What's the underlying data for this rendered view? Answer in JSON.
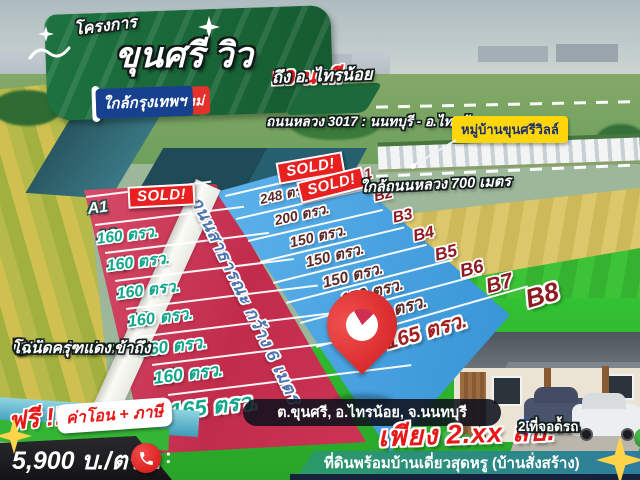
{
  "poster": {
    "project_label": "โครงการ",
    "project_name": "ขุนศรี วิว",
    "tagline_left": "พื้นที่ความสุขใหม่",
    "tagline_right": "ใกล้กรุงเทพฯ"
  },
  "callouts": {
    "travel_time": "10 นาที",
    "travel_dest": "ถึง อ. ไทรน้อย",
    "highway": "ถนนหลวง 3017 : นนทบุรี - อ.ไทรน้อย",
    "village_label": "หมู่บ้านขุนศรีวิลล์",
    "distance_note": "ใกล้ถนนหลวง 700 เมตร"
  },
  "road": {
    "label": "ถนนสาธารณะ กว้าง 6 เมตร"
  },
  "plots": {
    "sold_label": "SOLD!",
    "a": [
      {
        "id": "A1",
        "size": ""
      },
      {
        "id": "A2",
        "size": "160 ตรว."
      },
      {
        "id": "A3",
        "size": "160 ตรว."
      },
      {
        "id": "A4",
        "size": "160 ตรว."
      },
      {
        "id": "A5",
        "size": "160 ตรว."
      },
      {
        "id": "A6",
        "size": "160 ตรว."
      },
      {
        "id": "A7",
        "size": "160 ตรว."
      },
      {
        "id": "A8",
        "size": "165 ตรว."
      }
    ],
    "b": [
      {
        "id": "B1",
        "size": "248 ตรว."
      },
      {
        "id": "B2",
        "size": "200 ตรว."
      },
      {
        "id": "B3",
        "size": "150 ตรว."
      },
      {
        "id": "B4",
        "size": "150 ตรว."
      },
      {
        "id": "B5",
        "size": "150 ตรว."
      },
      {
        "id": "B6",
        "size": "150 ตรว."
      },
      {
        "id": "B7",
        "size": "150 ตรว."
      },
      {
        "id": "B8",
        "size": "165 ตรว."
      }
    ]
  },
  "features": {
    "items": [
      {
        "label": "ไฟฟ้า+ประปา เข้าถึง"
      },
      {
        "label": "โฉนดครุฑแดง"
      }
    ]
  },
  "promo": {
    "free_label": "ฟรี !!",
    "free_items": "ค่าโอน + ภาษี",
    "price_per_unit": "5,900 บ./ตรว.",
    "phone_suffix": ":"
  },
  "location": {
    "address": "ต.ขุนศรี, อ.ไทรน้อย, จ.นนทบุรี"
  },
  "offer": {
    "price": "เพียง 2.xx ลบ.",
    "tagline": "ที่ดินพร้อมบ้านเดี่ยวสุดหรู (บ้านสั่งสร้าง)"
  },
  "house_specs": {
    "items": [
      {
        "label": "3 ห้องนอน"
      },
      {
        "label": "2 ห้องน้ำ"
      },
      {
        "label": "2 ที่จอดรถ"
      }
    ]
  },
  "icons": {
    "check_glyph": "✓"
  },
  "colors": {
    "brand_green": "#1d6f3e",
    "accent_red": "#e5312b",
    "accent_blue": "#17418f",
    "plot_red": "#c22c4c",
    "plot_blue": "#3f9ddd",
    "sold_red": "#e82020",
    "highlight_yellow": "#ffd60a",
    "grass_green": "#2ec02e"
  }
}
